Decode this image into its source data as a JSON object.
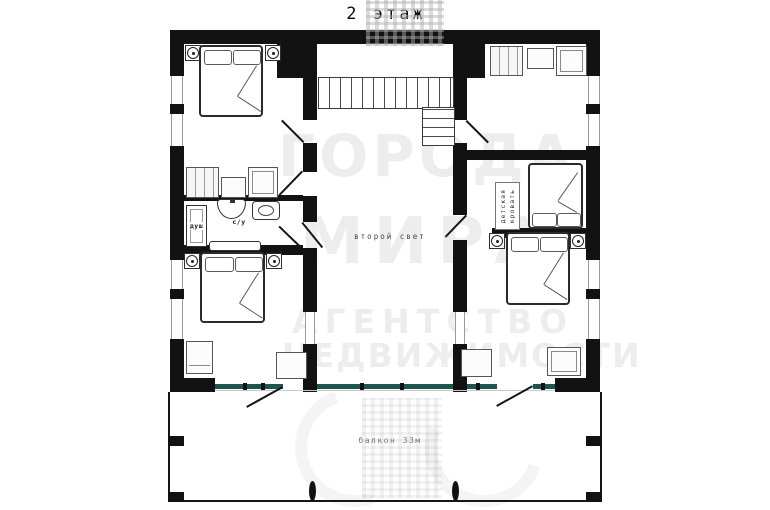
{
  "title": "2 этаж",
  "labels": {
    "shower": "душ",
    "wc": "с/у",
    "second_light": "второй свет",
    "kids_bed_word1": "детская",
    "kids_bed_word2": "кровать",
    "balcony": "балкон 33м"
  },
  "watermark": {
    "brand_line1": "ГОРОДА",
    "brand_line2": "МИРА",
    "tagline_line1": "АГЕНТСТВО",
    "tagline_line2": "НЕДВИЖИМОСТИ"
  },
  "colors": {
    "wall": "#121212",
    "glazing": "#1e5550",
    "furniture_stroke": "#555555",
    "label_text": "#3a3a3a",
    "watermark_text": "#ebebeb"
  }
}
